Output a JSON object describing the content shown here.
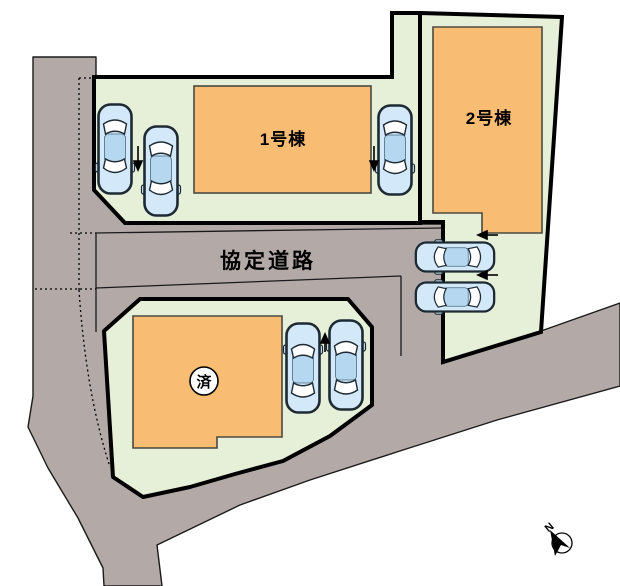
{
  "plan": {
    "buildings": [
      {
        "label": "1号棟"
      },
      {
        "label": "2号棟"
      }
    ],
    "road_label": "協定道路",
    "sold_badge": "済",
    "compass_label": "N"
  },
  "colors": {
    "background": "#ffffff",
    "road": "#b3aaa7",
    "lot": "#e6efd7",
    "building": "#f8bc72",
    "building_outline": "#4a4a42",
    "outline": "#000000",
    "thin_line": "#1a1a1a",
    "car_body": "#d3e8f8",
    "car_roof": "#b5d8f0",
    "car_outline": "#1d2a33",
    "badge_fill": "#ffffff"
  }
}
